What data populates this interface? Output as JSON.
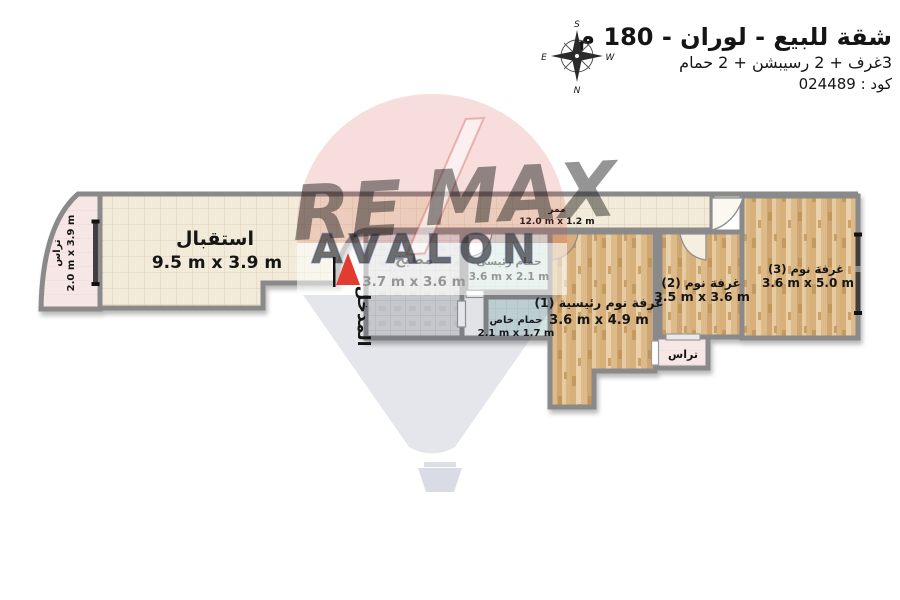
{
  "header": {
    "title": "شقة للبيع - لوران - 180 م",
    "subtitle": "3غرف + 2 رسيبشن + 2 حمام",
    "code": "كود : 024489"
  },
  "compass": {
    "top": "S",
    "bottom": "N",
    "left": "E",
    "right": "W"
  },
  "watermark": {
    "brand_left": "RE",
    "brand_right": "MAX",
    "brand_sub": "AVALON"
  },
  "entrance_label": "المدخل",
  "rooms": {
    "terrace_left": {
      "name": "تراس",
      "dims": "2.0 m x 3.9 m"
    },
    "reception": {
      "name": "استقبال",
      "dims": "9.5 m x 3.9 m"
    },
    "corridor": {
      "name": "ممر",
      "dims": "12.0 m x 1.2 m"
    },
    "kitchen": {
      "name": "مطبخ",
      "dims": "3.7 m x 3.6 m"
    },
    "bath_main": {
      "name": "حمام رئيسى",
      "dims": "3.6 m x 2.1 m"
    },
    "bath_private": {
      "name": "حمام خاص",
      "dims": "2.1 m x 1.7 m"
    },
    "bedroom_1": {
      "name": "غرفة نوم رئيسية (1)",
      "dims": "3.6 m x 4.9 m"
    },
    "bedroom_2": {
      "name": "غرفة نوم (2)",
      "dims": "3.5 m x 3.6 m"
    },
    "bedroom_3": {
      "name": "غرفة نوم (3)",
      "dims": "3.6 m x 5.0 m"
    },
    "terrace_right": {
      "name": "تراس"
    }
  },
  "colors": {
    "wall": "#8a8a8a",
    "tile": "#f2ebd9",
    "kitchen_tile": "#dcdcdc",
    "bath_tile": "#d2e4e0",
    "terrace_pink": "#f7e6e6",
    "wood": "#e3c497",
    "arrow_red": "#e23b30",
    "brand_red": "#c5332e",
    "brand_navy": "#2e3d66"
  }
}
